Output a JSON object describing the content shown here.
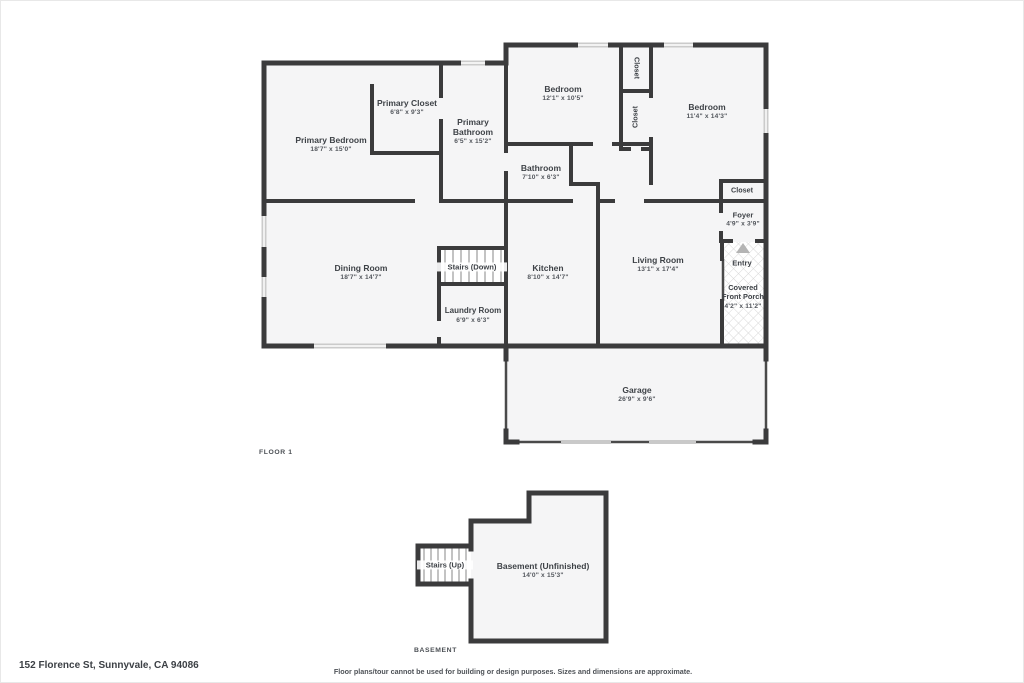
{
  "page": {
    "wall_color": "#3b3b3c",
    "room_fill": "#f5f5f6",
    "window_color": "#cbcbcb",
    "tread_color": "#9b9b9b",
    "text_color": "#3e4247"
  },
  "floor1": {
    "caption": "FLOOR 1",
    "rooms": {
      "primary_bedroom": {
        "name": "Primary Bedroom",
        "dims": "18'7\" x 15'0\""
      },
      "primary_closet": {
        "name": "Primary Closet",
        "dims": "6'8\" x 9'3\""
      },
      "primary_bathroom": {
        "name": "Primary Bathroom",
        "dims": "6'5\" x 15'2\""
      },
      "bedroom_a": {
        "name": "Bedroom",
        "dims": "12'1\" x 10'5\""
      },
      "bedroom_b": {
        "name": "Bedroom",
        "dims": "11'4\" x 14'3\""
      },
      "closet_top": {
        "name": "Closet"
      },
      "closet_mid": {
        "name": "Closet"
      },
      "closet_right": {
        "name": "Closet"
      },
      "bathroom": {
        "name": "Bathroom",
        "dims": "7'10\" x 6'3\""
      },
      "foyer": {
        "name": "Foyer",
        "dims": "4'9\" x 3'9\""
      },
      "entry": {
        "name": "Entry"
      },
      "covered_front_porch": {
        "name": "Covered Front Porch",
        "dims": "4'2\" x 11'2\""
      },
      "dining_room": {
        "name": "Dining Room",
        "dims": "18'7\" x 14'7\""
      },
      "stairs_down": {
        "name": "Stairs (Down)"
      },
      "kitchen": {
        "name": "Kitchen",
        "dims": "8'10\" x 14'7\""
      },
      "living_room": {
        "name": "Living Room",
        "dims": "13'1\" x 17'4\""
      },
      "laundry_room": {
        "name": "Laundry Room",
        "dims": "6'9\" x 6'3\""
      },
      "garage": {
        "name": "Garage",
        "dims": "26'9\" x 9'6\""
      }
    }
  },
  "basement": {
    "caption": "BASEMENT",
    "rooms": {
      "stairs_up": {
        "name": "Stairs (Up)"
      },
      "basement_unfinished": {
        "name": "Basement (Unfinished)",
        "dims": "14'0\" x 15'3\""
      }
    }
  },
  "footer": {
    "address": "152 Florence St, Sunnyvale, CA 94086",
    "disclaimer": "Floor plans/tour cannot be used for building or design purposes. Sizes and dimensions are approximate."
  }
}
